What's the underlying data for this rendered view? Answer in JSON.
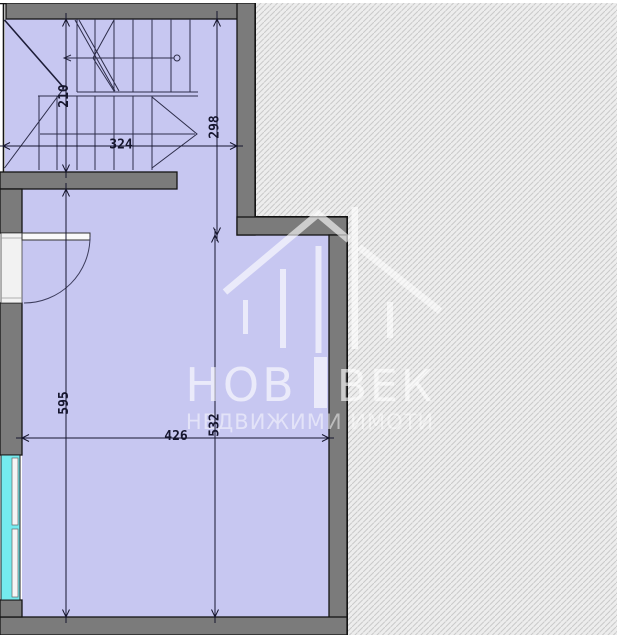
{
  "watermark": {
    "brand_left": "НОВ",
    "brand_right": "ВЕК",
    "tagline": "НЕДВИЖИМИ ИМОТИ"
  },
  "dims": {
    "d210": "210",
    "d324": "324",
    "d298": "298",
    "d595": "595",
    "d426": "426",
    "d532": "532"
  },
  "colors": {
    "room_fill": "#c7c7f1",
    "wall_fill": "#7b7b7b",
    "wall_outline": "#141414",
    "window_glass": "#74ebee",
    "hatch_background": "#ededed",
    "hatch_line": "#cacaca",
    "dim_line": "#16162e",
    "watermark_white": "rgba(255,255,255,0.62)"
  }
}
